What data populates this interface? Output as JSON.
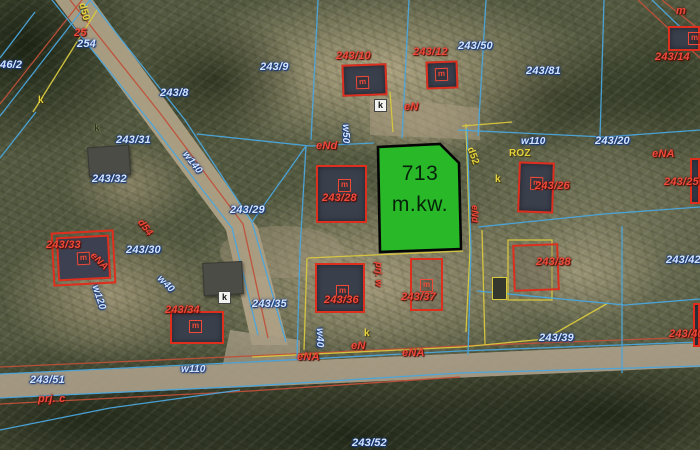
{
  "map": {
    "title": "cadastral aerial map view",
    "highlight_parcel": {
      "area_value": "713",
      "area_unit": "m.kw.",
      "fill_color": "#28b828",
      "border_color": "#000000"
    },
    "colors": {
      "parcel_line_blue": "#4aa6de",
      "utility_line_red": "#c0503a",
      "utility_line_yellow": "#d9c93e",
      "building_outline_red": "#de2f1e",
      "label_blue": "#d4e4ff",
      "label_red": "#ef4a3a",
      "label_yellow": "#e6d23c",
      "road_fill": "#b5a78c"
    },
    "building_marker": "m",
    "labels": [
      {
        "t": "25",
        "c": "red",
        "x": 74,
        "y": 28
      },
      {
        "t": "254",
        "c": "blue",
        "x": 77,
        "y": 39
      },
      {
        "t": "d50",
        "c": "yellow",
        "x": 86,
        "y": 2,
        "rot": 75
      },
      {
        "t": "46/2",
        "c": "blue",
        "x": 0,
        "y": 60
      },
      {
        "t": "k",
        "c": "yellow",
        "x": 38,
        "y": 96
      },
      {
        "t": "243/8",
        "c": "blue",
        "x": 160,
        "y": 88
      },
      {
        "t": "243/9",
        "c": "blue",
        "x": 260,
        "y": 62
      },
      {
        "t": "243/10",
        "c": "red",
        "x": 336,
        "y": 51
      },
      {
        "t": "243/12",
        "c": "red",
        "x": 413,
        "y": 47
      },
      {
        "t": "243/50",
        "c": "blue",
        "x": 458,
        "y": 41
      },
      {
        "t": "243/81",
        "c": "blue",
        "x": 526,
        "y": 66
      },
      {
        "t": "243/14",
        "c": "red",
        "x": 655,
        "y": 52
      },
      {
        "t": "m",
        "c": "red",
        "x": 676,
        "y": 6
      },
      {
        "t": "k",
        "c": "kbox",
        "x": 374,
        "y": 99
      },
      {
        "t": "eN",
        "c": "red",
        "x": 404,
        "y": 102
      },
      {
        "t": "eNd",
        "c": "red",
        "x": 316,
        "y": 141
      },
      {
        "t": "w50",
        "c": "blue",
        "x": 350,
        "y": 124,
        "rot": 90,
        "sz": 10
      },
      {
        "t": "k",
        "c": "dark",
        "x": 94,
        "y": 124
      },
      {
        "t": "243/31",
        "c": "blue",
        "x": 116,
        "y": 135
      },
      {
        "t": "w140",
        "c": "blue",
        "x": 188,
        "y": 150,
        "rot": 52,
        "sz": 10
      },
      {
        "t": "243/32",
        "c": "blue",
        "x": 92,
        "y": 174
      },
      {
        "t": "d52",
        "c": "yellow",
        "x": 474,
        "y": 146,
        "rot": 70
      },
      {
        "t": "ROZ",
        "c": "yellow",
        "x": 509,
        "y": 149
      },
      {
        "t": "k",
        "c": "yellow",
        "x": 495,
        "y": 175
      },
      {
        "t": "w110",
        "c": "blue",
        "x": 521,
        "y": 137,
        "sz": 10
      },
      {
        "t": "243/20",
        "c": "blue",
        "x": 595,
        "y": 136
      },
      {
        "t": "eNA",
        "c": "red",
        "x": 652,
        "y": 149
      },
      {
        "t": "243/26",
        "c": "red",
        "x": 535,
        "y": 181
      },
      {
        "t": "243/25",
        "c": "red",
        "x": 664,
        "y": 177
      },
      {
        "t": "eNd",
        "c": "red",
        "x": 479,
        "y": 205,
        "rot": 90,
        "sz": 9
      },
      {
        "t": "243/29",
        "c": "blue",
        "x": 230,
        "y": 205
      },
      {
        "t": "d54",
        "c": "red",
        "x": 143,
        "y": 218,
        "rot": 52,
        "sz": 10
      },
      {
        "t": "243/33",
        "c": "red",
        "x": 46,
        "y": 240
      },
      {
        "t": "eNA",
        "c": "red",
        "x": 95,
        "y": 251,
        "rot": 45,
        "sz": 10
      },
      {
        "t": "243/30",
        "c": "blue",
        "x": 126,
        "y": 245
      },
      {
        "t": "w40",
        "c": "blue",
        "x": 162,
        "y": 274,
        "rot": 45,
        "sz": 10
      },
      {
        "t": "w120",
        "c": "blue",
        "x": 99,
        "y": 284,
        "rot": 72,
        "sz": 10
      },
      {
        "t": "243/28",
        "c": "red",
        "x": 322,
        "y": 193
      },
      {
        "t": "243/35",
        "c": "blue",
        "x": 252,
        "y": 299
      },
      {
        "t": "243/36",
        "c": "red",
        "x": 324,
        "y": 295
      },
      {
        "t": "243/37",
        "c": "red",
        "x": 401,
        "y": 292
      },
      {
        "t": "prj. w",
        "c": "red",
        "x": 383,
        "y": 262,
        "rot": 90,
        "sz": 9
      },
      {
        "t": "243/38",
        "c": "red",
        "x": 536,
        "y": 257
      },
      {
        "t": "243/42",
        "c": "blue",
        "x": 666,
        "y": 255
      },
      {
        "t": "243/34",
        "c": "red",
        "x": 165,
        "y": 305
      },
      {
        "t": "k",
        "c": "kbox",
        "x": 218,
        "y": 291
      },
      {
        "t": "w40",
        "c": "blue",
        "x": 324,
        "y": 328,
        "rot": 90,
        "sz": 10
      },
      {
        "t": "k",
        "c": "yellow",
        "x": 364,
        "y": 329
      },
      {
        "t": "eN",
        "c": "red",
        "x": 351,
        "y": 341
      },
      {
        "t": "eNA",
        "c": "red",
        "x": 297,
        "y": 352
      },
      {
        "t": "eNA",
        "c": "red",
        "x": 402,
        "y": 348
      },
      {
        "t": "w110",
        "c": "blue",
        "x": 181,
        "y": 365,
        "sz": 10
      },
      {
        "t": "243/39",
        "c": "blue",
        "x": 539,
        "y": 333
      },
      {
        "t": "243/40",
        "c": "red",
        "x": 669,
        "y": 329
      },
      {
        "t": "243/51",
        "c": "blue",
        "x": 30,
        "y": 375
      },
      {
        "t": "prj. c",
        "c": "red",
        "x": 38,
        "y": 394
      },
      {
        "t": "243/52",
        "c": "blue",
        "x": 352,
        "y": 438
      }
    ],
    "buildings": [
      {
        "x": 342,
        "y": 64,
        "w": 45,
        "h": 32,
        "v": "dark",
        "rot": -2,
        "m": true,
        "mx": 12,
        "my": 10
      },
      {
        "x": 426,
        "y": 61,
        "w": 32,
        "h": 28,
        "v": "dark",
        "rot": -2,
        "m": true,
        "mx": 7,
        "my": 5
      },
      {
        "x": 668,
        "y": 26,
        "w": 32,
        "h": 25,
        "v": "dark",
        "rot": 0,
        "m": true,
        "mx": 18,
        "my": 4
      },
      {
        "x": 316,
        "y": 165,
        "w": 51,
        "h": 58,
        "v": "dark",
        "rot": 0,
        "m": true,
        "mx": 20,
        "my": 12
      },
      {
        "x": 518,
        "y": 162,
        "w": 36,
        "h": 51,
        "v": "dark",
        "rot": 2,
        "m": true,
        "mx": 10,
        "my": 13
      },
      {
        "x": 690,
        "y": 158,
        "w": 10,
        "h": 46,
        "v": "dark",
        "rot": 0,
        "m": false
      },
      {
        "x": 57,
        "y": 236,
        "w": 53,
        "h": 44,
        "v": "double",
        "rot": -3,
        "m": true,
        "mx": 18,
        "my": 14
      },
      {
        "x": 315,
        "y": 263,
        "w": 50,
        "h": 50,
        "v": "dark",
        "rot": 0,
        "m": true,
        "mx": 19,
        "my": 20
      },
      {
        "x": 410,
        "y": 258,
        "w": 33,
        "h": 53,
        "v": "outline",
        "rot": 0,
        "m": true,
        "mx": 8,
        "my": 19
      },
      {
        "x": 170,
        "y": 311,
        "w": 54,
        "h": 33,
        "v": "dark",
        "rot": 0,
        "m": true,
        "mx": 17,
        "my": 7
      },
      {
        "x": 513,
        "y": 244,
        "w": 46,
        "h": 47,
        "v": "outline",
        "rot": -2,
        "m": false
      },
      {
        "x": 693,
        "y": 303,
        "w": 7,
        "h": 44,
        "v": "dark",
        "rot": 0,
        "m": false
      },
      {
        "x": 203,
        "y": 262,
        "w": 40,
        "h": 33,
        "v": "gray",
        "rot": -3,
        "m": false
      },
      {
        "x": 88,
        "y": 146,
        "w": 42,
        "h": 30,
        "v": "gray",
        "rot": -4,
        "m": false
      },
      {
        "x": 492,
        "y": 277,
        "w": 15,
        "h": 23,
        "v": "shed",
        "rot": 0,
        "m": false
      }
    ]
  }
}
